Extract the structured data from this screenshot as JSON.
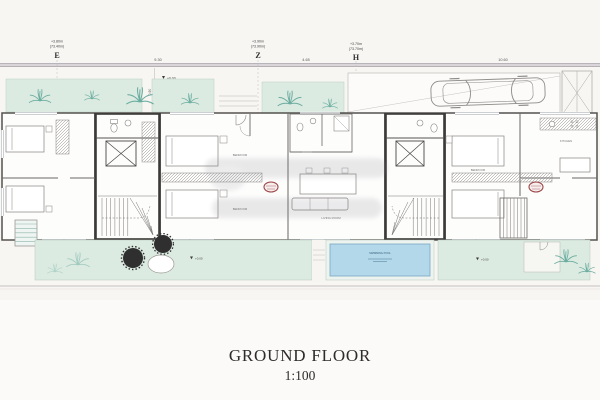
{
  "drawing": {
    "title": "GROUND FLOOR",
    "scale": "1:100"
  },
  "grid_markers": [
    {
      "letter": "E",
      "elevation": "+3.80m",
      "datum": "(73.40m)"
    },
    {
      "letter": "Z",
      "elevation": "+3.90m",
      "datum": "(73.90m)"
    },
    {
      "letter": "H",
      "elevation": "+3.70m",
      "datum": "(73.70m)"
    }
  ],
  "dimensions": {
    "span_e_z": "9.30",
    "span_z_h": "4.65",
    "span_right": "10.60",
    "setback": "0.90"
  },
  "levels": {
    "zero": "+0.00"
  },
  "room_labels": {
    "bedroom": "BEDROOM",
    "living_room": "LIVING ROOM",
    "kitchen": "KITCHEN",
    "pool": "SWIMMING POOL"
  },
  "colors": {
    "garden_green": "#dcebe2",
    "plant_teal": "#4f9e8f",
    "pool_blue": "#b3d8e9",
    "wall_gray": "#474747",
    "stamp_red": "#9c4444",
    "road_gray": "#d9d5d9"
  }
}
